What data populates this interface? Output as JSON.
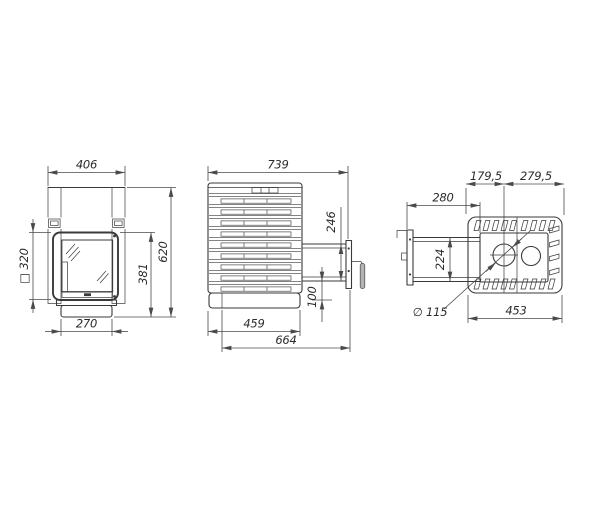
{
  "colors": {
    "background": "#ffffff",
    "line": "#3a3a3a",
    "dim_line": "#4a4a4a",
    "text": "#2b2b2b",
    "handle_fill": "#b3b3b3"
  },
  "front": {
    "width_top": "406",
    "height_total": "620",
    "firebox_height": "381",
    "door_square": "□ 320",
    "base_width": "270"
  },
  "side": {
    "depth_total": "739",
    "tunnel_height": "246",
    "plinth_height": "100",
    "body_depth": "459",
    "depth_with_door": "664"
  },
  "top": {
    "chimney_offset_front": "179,5",
    "chimney_offset_back": "279,5",
    "tunnel_length": "280",
    "tunnel_width": "224",
    "body_depth": "453",
    "chimney_diameter": "∅ 115"
  }
}
